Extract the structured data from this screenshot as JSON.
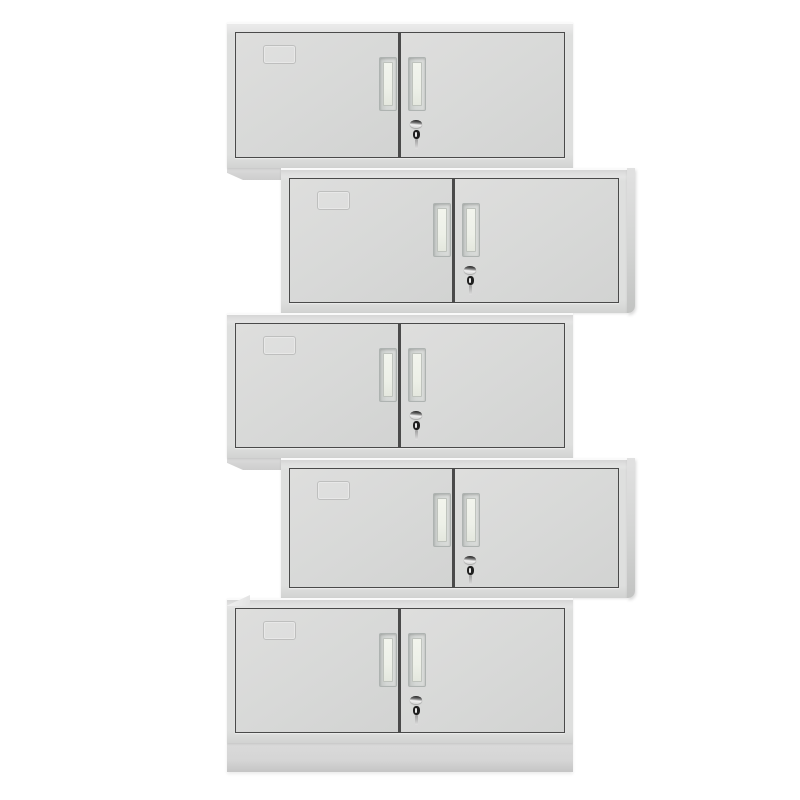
{
  "scene": {
    "description": "Product photo of five identical light-grey two-door steel office cabinets stacked in a staggered zig-zag column on a plain white background",
    "background_color": "#ffffff",
    "cabinet_count": 5,
    "visible_text": ""
  },
  "palette": {
    "body_face": "#dedfde",
    "body_top_highlight": "#fafafa",
    "top_strip": "#e8e8e8",
    "door_face": "#d8d9d8",
    "door_face_dark": "#d2d3d2",
    "door_outline": "#4a4a4a",
    "side_panel": "#d3d4d3",
    "side_panel_dark": "#c2c3c2",
    "foot": "#cdcdcd",
    "plinth": "#d5d5d5",
    "handle_frame": "#aeb3b1",
    "handle_grip": "#f2f4ed",
    "lock_chrome_light": "#f2f2f2",
    "lock_chrome_dark": "#2e2e2e",
    "key_color": "#1f1f1f",
    "key_slit": "#e8e8e8",
    "label_outline": "#b9bab9",
    "contact_shadow": "rgba(0,0,0,0.16)"
  },
  "cabinets": [
    {
      "id": "cabinet-1",
      "left": 227,
      "top": 22,
      "height": 146,
      "offset_side": "left",
      "has_foot": true,
      "has_side_panel": false,
      "has_plinth": false,
      "has_corner_bevel": false
    },
    {
      "id": "cabinet-2",
      "left": 281,
      "top": 168,
      "height": 145,
      "offset_side": "right",
      "has_foot": false,
      "has_side_panel": true,
      "has_plinth": false,
      "has_corner_bevel": false
    },
    {
      "id": "cabinet-3",
      "left": 227,
      "top": 313,
      "height": 145,
      "offset_side": "left",
      "has_foot": true,
      "has_side_panel": false,
      "has_plinth": false,
      "has_corner_bevel": false
    },
    {
      "id": "cabinet-4",
      "left": 281,
      "top": 458,
      "height": 140,
      "offset_side": "right",
      "has_foot": false,
      "has_side_panel": true,
      "has_plinth": false,
      "has_corner_bevel": false
    },
    {
      "id": "cabinet-5",
      "left": 227,
      "top": 598,
      "height": 145,
      "offset_side": "left",
      "has_foot": false,
      "has_side_panel": false,
      "has_plinth": true,
      "has_corner_bevel": true
    }
  ],
  "cabinet_features": {
    "doors_per_cabinet": 2,
    "handles": "two recessed vertical pulls flanking the centre stile",
    "lock": "chrome cam lock with dark key inserted, on the right door below its handle",
    "label_holder": "faint embossed card frame on the upper-left of the left door"
  }
}
